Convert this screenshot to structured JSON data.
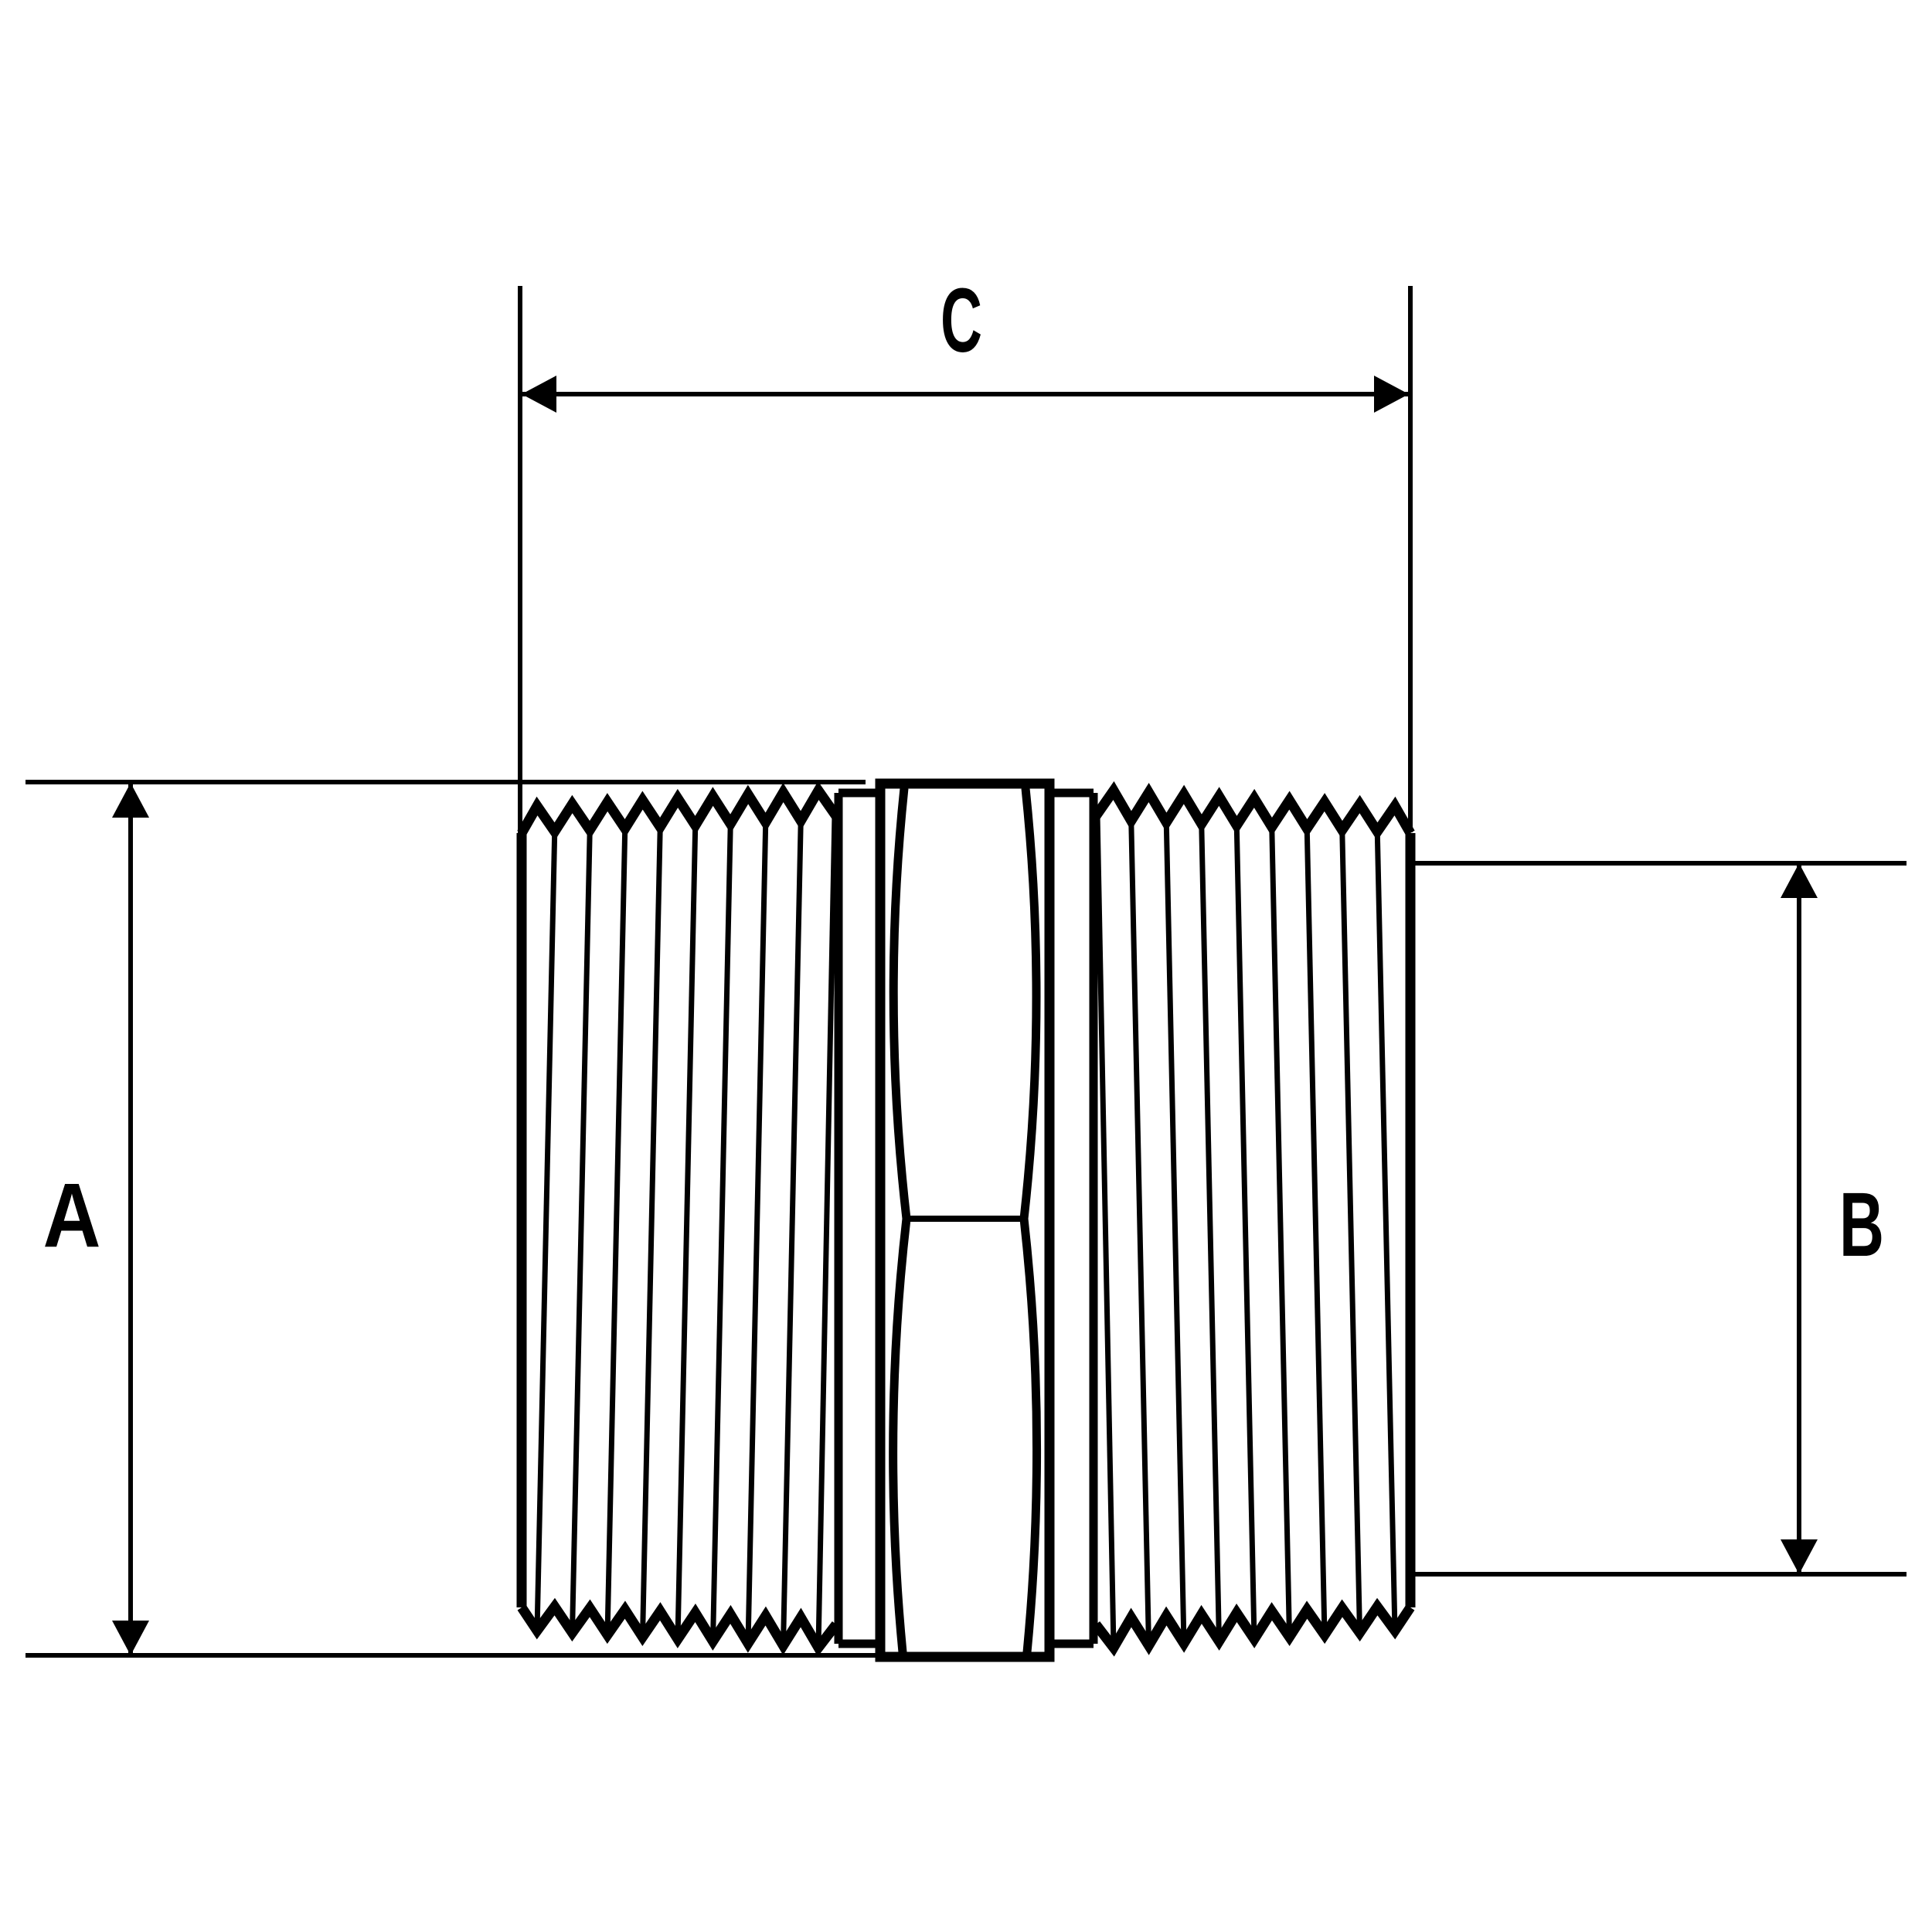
{
  "drawing": {
    "labels": {
      "a": "A",
      "b": "B",
      "c": "C"
    }
  },
  "colors": {
    "line": "#000000",
    "background": "#ffffff"
  }
}
